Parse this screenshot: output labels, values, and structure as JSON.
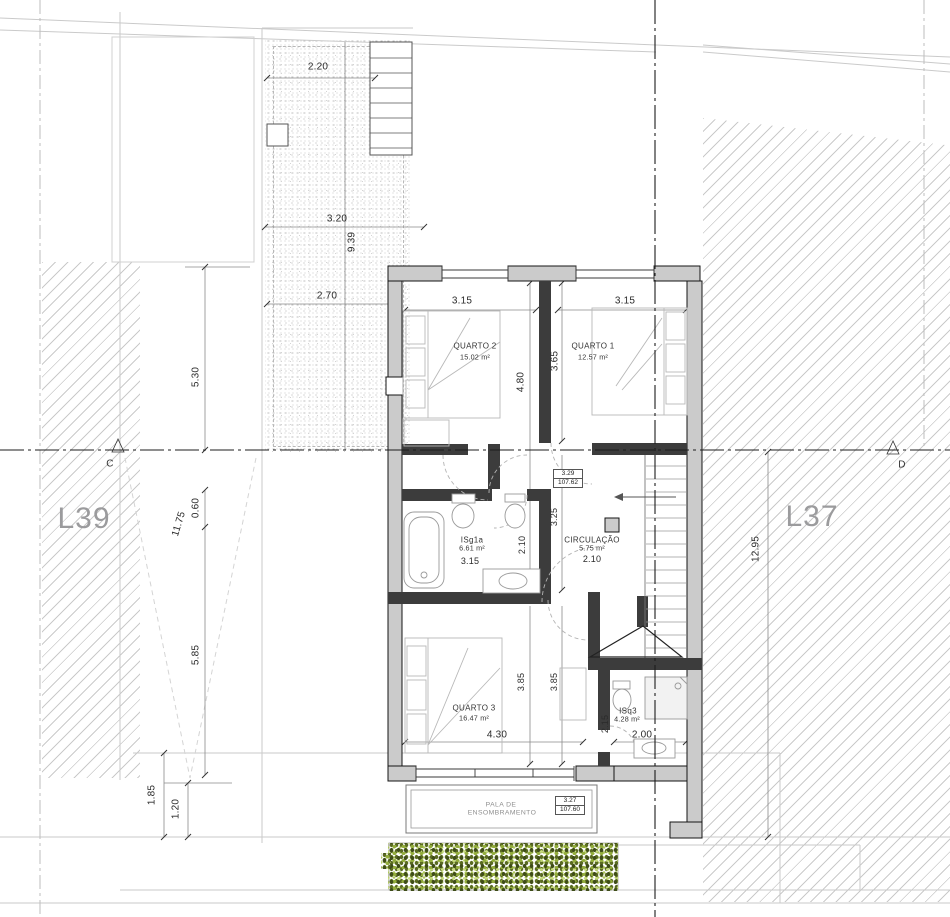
{
  "lots": {
    "left": "L39",
    "right": "L37"
  },
  "sections": {
    "left": "C",
    "right": "D"
  },
  "rooms": {
    "quarto2": {
      "name": "QUARTO 2",
      "area": "15.02 m²"
    },
    "quarto1": {
      "name": "QUARTO 1",
      "area": "12.57 m²"
    },
    "isg1a": {
      "name": "ISg1a",
      "area": "6.61 m²"
    },
    "circulacao": {
      "name": "CIRCULAÇÃO",
      "area": "5.75 m²"
    },
    "quarto3": {
      "name": "QUARTO 3",
      "area": "16.47 m²"
    },
    "isq3": {
      "name": "ISq3",
      "area": "4.28 m²"
    }
  },
  "levels": {
    "upper": {
      "height": "3.29",
      "elevation": "107.62"
    },
    "lower": {
      "height": "3.27",
      "elevation": "107.60"
    }
  },
  "pala": {
    "line1": "PALA DE",
    "line2": "ENSOMBRAMENTO"
  },
  "dims": {
    "patio_top": "2.20",
    "patio_mid": "3.20",
    "patio_height": "9.39",
    "patio_low": "2.70",
    "left_upper": "5.30",
    "left_long": "11.75",
    "left_small": "0.60",
    "left_lower": "5.85",
    "bottom_a": "1.85",
    "bottom_b": "1.20",
    "right_long": "12.95",
    "q2_w": "3.15",
    "q2_h": "4.80",
    "q1_w": "3.15",
    "q1_h": "3.65",
    "isg1a_w": "3.15",
    "isg1a_h": "2.10",
    "circ_w": "2.10",
    "circ_h": "3.25",
    "q3_w": "4.30",
    "q3_h1": "3.85",
    "q3_h2": "3.85",
    "isq3_w": "2.00",
    "isq3_h": "2.15"
  },
  "colors": {
    "wall_fill": "#cbcbcb",
    "wall_dark": "#3c3c3c",
    "hatch": "#bfbfbf",
    "axis": "#1c1c1c",
    "label_gray": "#9b9b9d",
    "veg_light": "#b7cc63",
    "veg_dark": "#4b5a1e"
  }
}
